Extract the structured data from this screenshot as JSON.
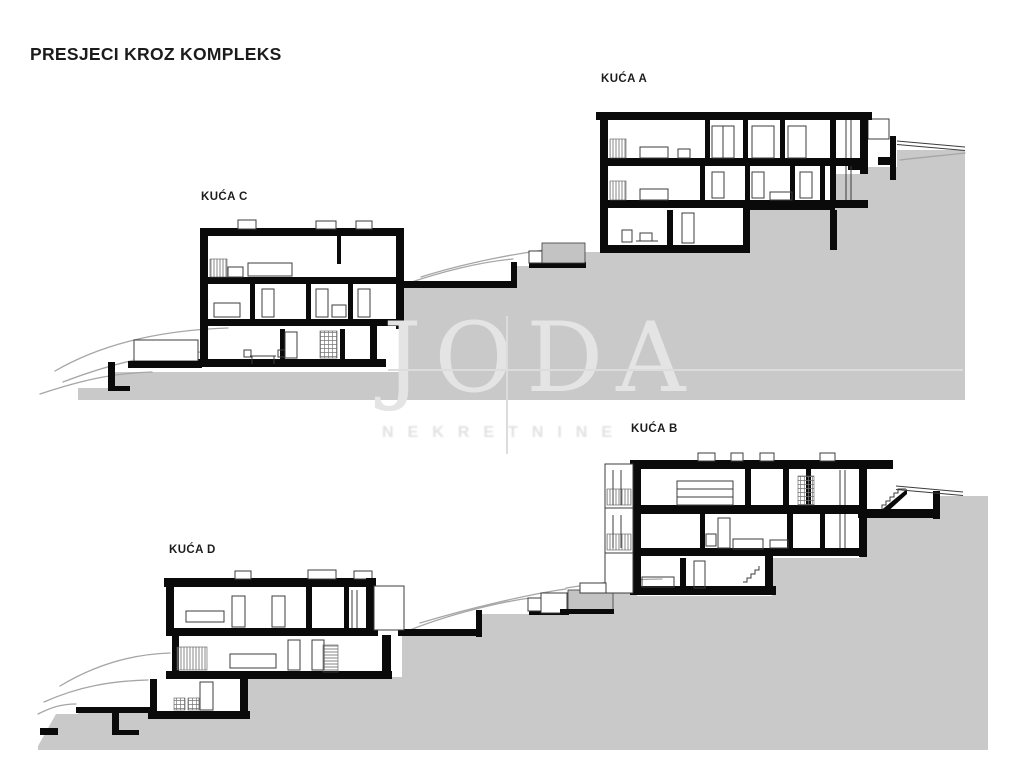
{
  "title": "PRESJECI KROZ KOMPLEKS",
  "watermark": {
    "brand": "JODA",
    "tagline": "NEKRETNINE"
  },
  "sections": {
    "top": {
      "house_left": "KUĆA C",
      "house_right": "KUĆA A"
    },
    "bottom": {
      "house_left": "KUĆA D",
      "house_right": "KUĆA B"
    }
  },
  "drawing": {
    "kind": "architectural cross-sections of hillside housing complex",
    "houses": [
      "KUĆA A",
      "KUĆA B",
      "KUĆA C",
      "KUĆA D"
    ]
  },
  "colors": {
    "background": "#ffffff",
    "ink": "#0a0a0a",
    "terrain_fill": "#c9c9c9",
    "contour_line": "#a6a6a6",
    "watermark": "#e4e4e4"
  }
}
